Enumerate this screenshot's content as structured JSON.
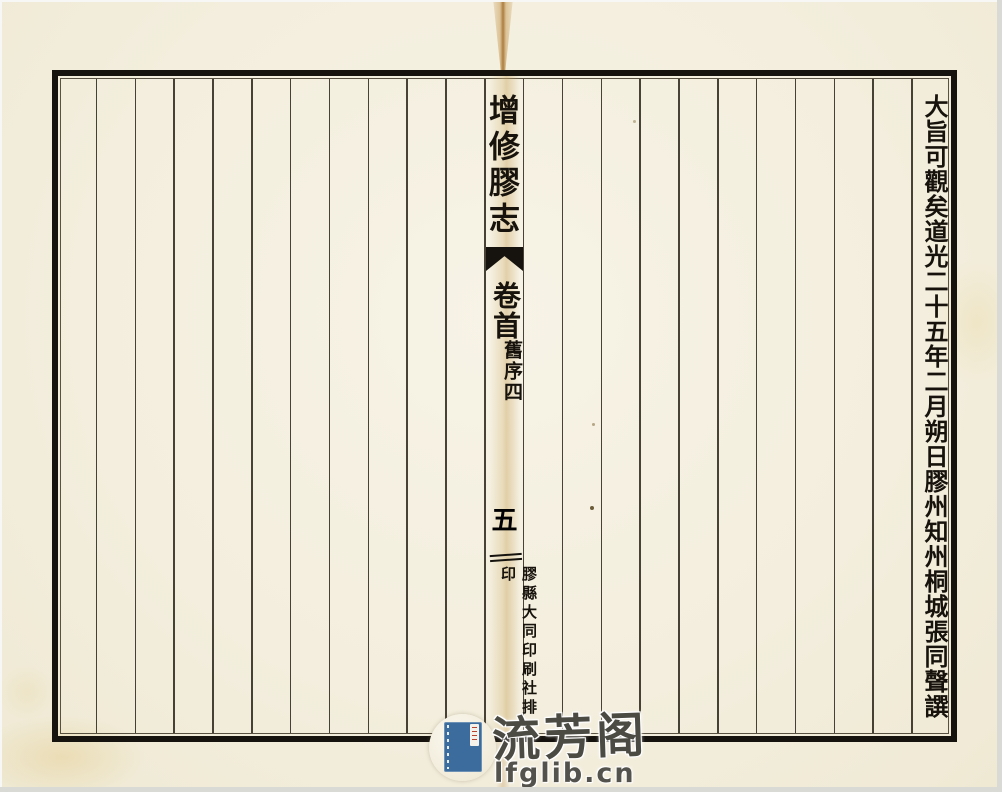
{
  "page": {
    "spine": {
      "book_title": "增修膠志",
      "volume_label": "卷首",
      "section_label": "舊序四",
      "page_number": "五",
      "publisher_imprint": "膠縣大同印刷社排印"
    },
    "preface_column_text": "大旨可觀矣道光二十五年二月朔日膠州知州桐城張同聲譔",
    "colors": {
      "paper": "#f3eedd",
      "ink": "#16130e",
      "crease": "#a06923",
      "logo_blue": "#3c6b9d",
      "watermark_text": "#4b4a43"
    }
  },
  "watermark": {
    "site_name": "流芳阁",
    "site_url": "lfglib.cn"
  }
}
